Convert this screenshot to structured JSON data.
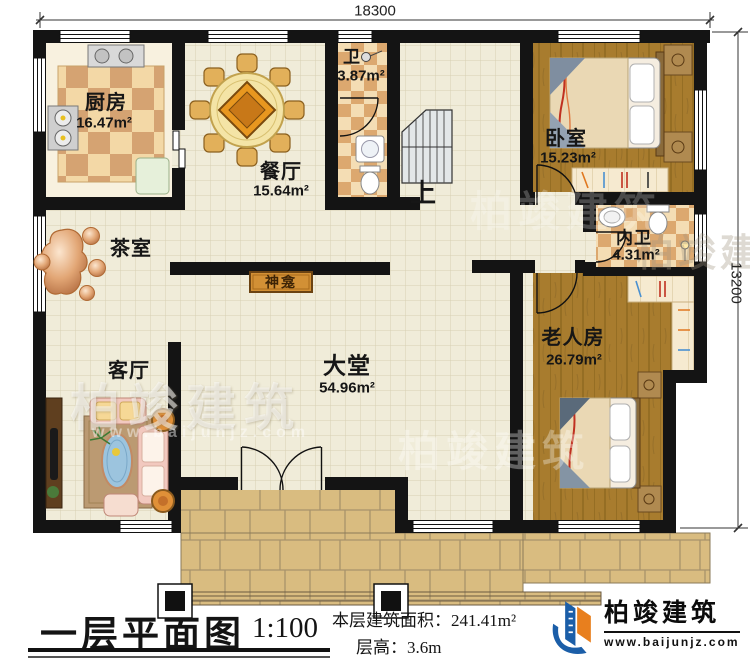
{
  "plan": {
    "dimensions": {
      "width_mm": "18300",
      "height_mm": "13200"
    },
    "rooms": {
      "kitchen": {
        "name": "厨房",
        "area": "16.47m²"
      },
      "dining": {
        "name": "餐厅",
        "area": "15.64m²"
      },
      "bath": {
        "name": "卫",
        "area": "3.87m²"
      },
      "bedroom": {
        "name": "卧室",
        "area": "15.23m²"
      },
      "ensuite": {
        "name": "内卫",
        "area": "4.31m²"
      },
      "tea_room": {
        "name": "茶室"
      },
      "living_room": {
        "name": "客厅"
      },
      "hall": {
        "name": "大堂",
        "area": "54.96m²"
      },
      "elder_room": {
        "name": "老人房",
        "area": "26.79m²"
      },
      "shrine": {
        "name": "神龛"
      },
      "stairs": {
        "up_label": "上"
      }
    }
  },
  "title_block": {
    "title": "一层平面图",
    "scale": "1:100",
    "area_label": "本层建筑面积：",
    "area_value": "241.41m²",
    "floor_height_label": "层高：",
    "floor_height_value": "3.6m"
  },
  "brand": {
    "name": "柏竣建筑",
    "website": "www.baijunjz.com"
  },
  "watermark": {
    "text": "柏竣建筑",
    "subtext": "www.baijunjz.com"
  },
  "colors": {
    "wall": "#141414",
    "wood_floor": "#a87c2e",
    "tile_floor": "#f0ecd9",
    "paving": "#d9bc80",
    "brand_blue": "#1b5ea8",
    "brand_orange": "#e87f1e"
  }
}
